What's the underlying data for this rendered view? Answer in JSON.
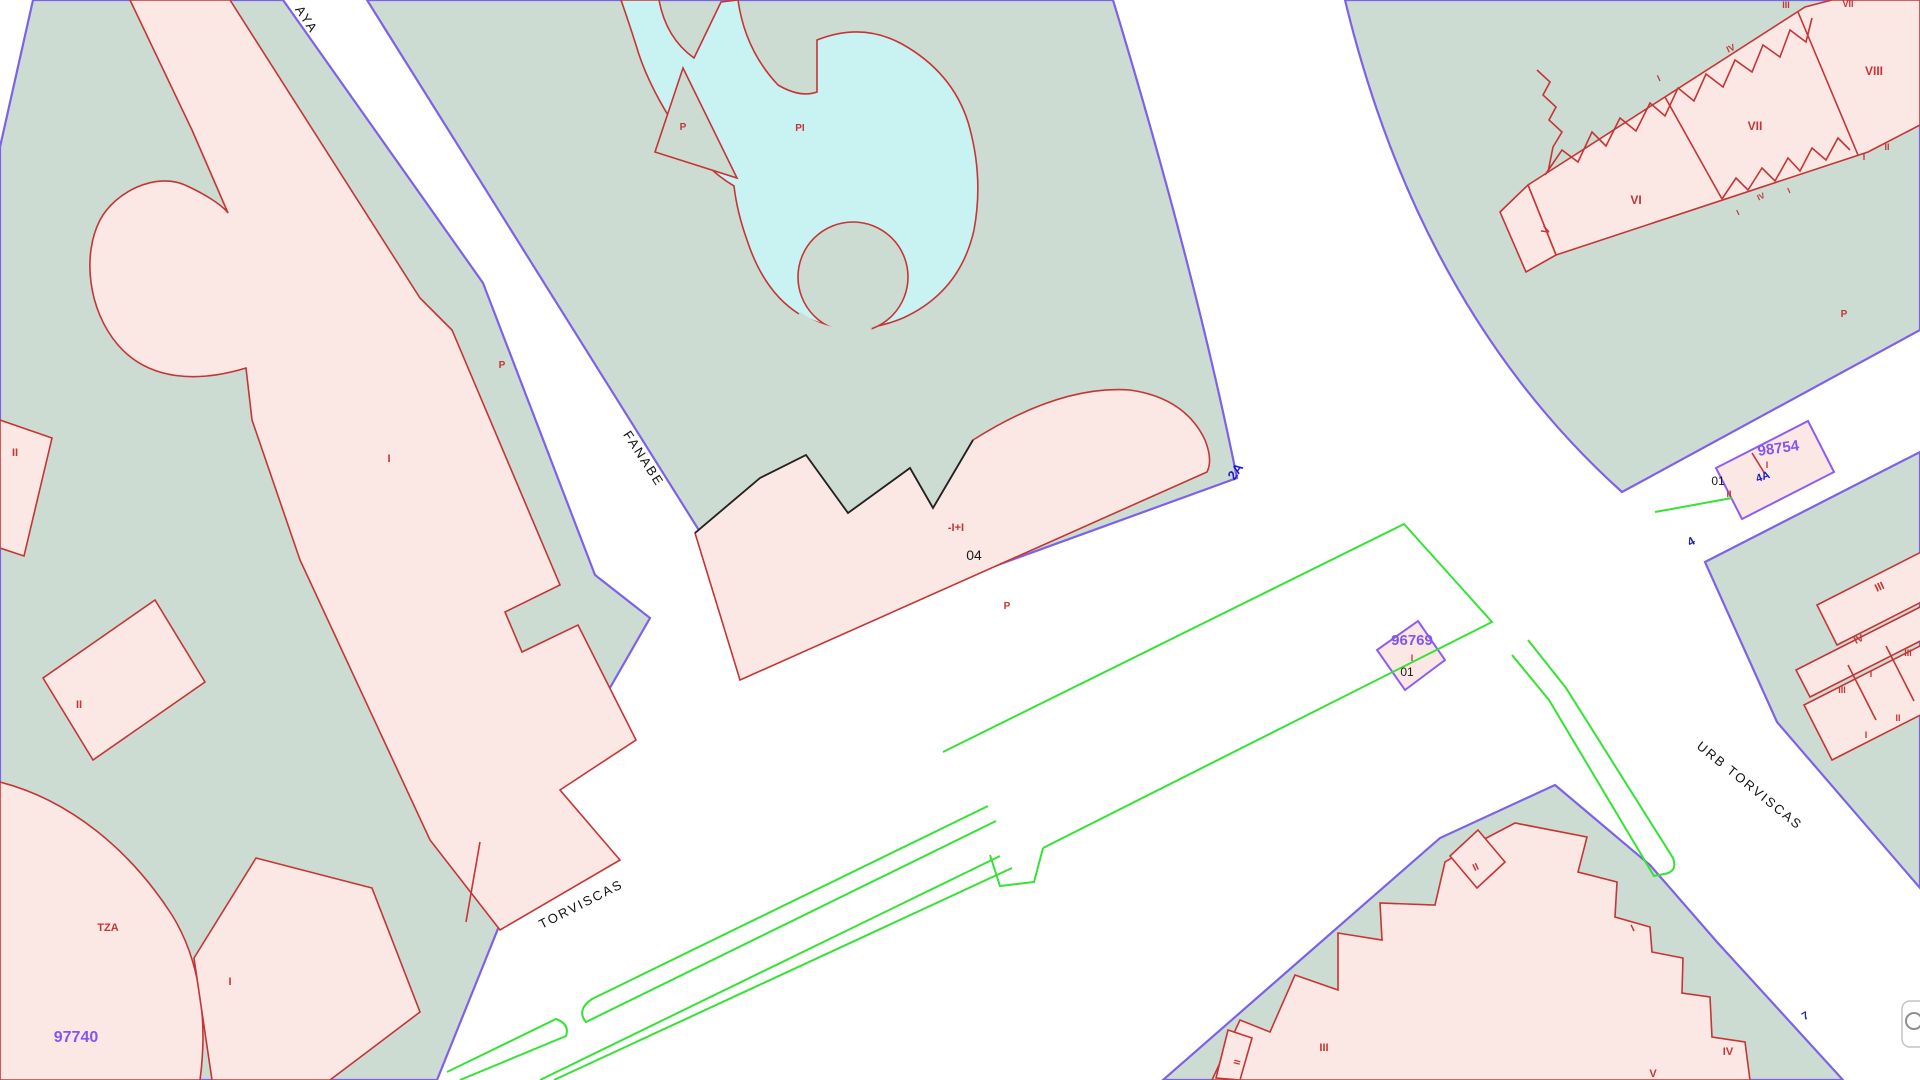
{
  "title": "Cadastral map viewer — Torviscas / Fanabe",
  "colors": {
    "street_white": "#ffffff",
    "block_green": "#ccdcd2",
    "parcel_pink": "#fbe7e4",
    "pool_cyan": "#c9f2f2",
    "outline_red": "#c53535",
    "boundary_purple": "#7d62e8",
    "curb_green": "#35e335",
    "parcel_number_purple": "#8257f0",
    "street_number_blue": "#1c1ccd",
    "text_black": "#1a1a1a"
  },
  "streets": [
    {
      "name": "AYA"
    },
    {
      "name": "FANABE"
    },
    {
      "name": "TORVISCAS"
    },
    {
      "name": "URB TORVISCAS"
    }
  ],
  "parcel_numbers": [
    "97740",
    "96769",
    "98754"
  ],
  "portal_numbers": [
    "04",
    "01",
    "01"
  ],
  "street_numbers": [
    "2A",
    "4",
    "4A",
    "7"
  ],
  "map_control": {
    "icon": "globe-icon"
  },
  "labels": [
    {
      "id": "street-aya",
      "t": "AYA",
      "x": 303,
      "y": 22,
      "c": "street",
      "s": 13,
      "r": 57
    },
    {
      "id": "street-fanabe",
      "t": "FANABE",
      "x": 640,
      "y": 461,
      "c": "street",
      "s": 13,
      "r": 57
    },
    {
      "id": "street-torviscas",
      "t": "TORVISCAS",
      "x": 583,
      "y": 908,
      "c": "street",
      "s": 13,
      "r": -27
    },
    {
      "id": "street-urb-torviscas",
      "t": "URB TORVISCAS",
      "x": 1747,
      "y": 789,
      "c": "street",
      "s": 13,
      "r": 39
    },
    {
      "id": "parcel-97740",
      "t": "97740",
      "x": 76,
      "y": 1042,
      "c": "ptext",
      "s": 16,
      "r": 0
    },
    {
      "id": "parcel-96769",
      "t": "96769",
      "x": 1412,
      "y": 645,
      "c": "ptext",
      "s": 15,
      "r": 0
    },
    {
      "id": "parcel-98754",
      "t": "98754",
      "x": 1779,
      "y": 453,
      "c": "ptext",
      "s": 15,
      "r": -8
    },
    {
      "id": "num-2a",
      "t": "2A",
      "x": 1239,
      "y": 474,
      "c": "blue",
      "s": 13,
      "r": -55
    },
    {
      "id": "num-4a",
      "t": "4A",
      "x": 1764,
      "y": 480,
      "c": "blue",
      "s": 11,
      "r": -20
    },
    {
      "id": "num-4",
      "t": "4",
      "x": 1693,
      "y": 545,
      "c": "blue",
      "s": 12,
      "r": -30
    },
    {
      "id": "num-7",
      "t": "7",
      "x": 1807,
      "y": 1019,
      "c": "blue",
      "s": 11,
      "r": -30
    },
    {
      "id": "portal-04",
      "t": "04",
      "x": 974,
      "y": 560,
      "c": "black",
      "s": 14,
      "r": 0
    },
    {
      "id": "portal-01-96769",
      "t": "01",
      "x": 1407,
      "y": 676,
      "c": "black",
      "s": 12,
      "r": 0
    },
    {
      "id": "portal-01-98754",
      "t": "01",
      "x": 1718,
      "y": 485,
      "c": "black",
      "s": 12,
      "r": 0
    },
    {
      "id": "bld-floors",
      "t": "-I+I",
      "x": 956,
      "y": 531,
      "c": "red",
      "s": 11,
      "r": 0
    },
    {
      "id": "bld-p-1",
      "t": "P",
      "x": 1007,
      "y": 609,
      "c": "red",
      "s": 10,
      "r": 0
    },
    {
      "id": "bld-p-2",
      "t": "P",
      "x": 502,
      "y": 368,
      "c": "red",
      "s": 10,
      "r": 0
    },
    {
      "id": "pool-p",
      "t": "P",
      "x": 683,
      "y": 130,
      "c": "red",
      "s": 10,
      "r": 0
    },
    {
      "id": "pool-pi",
      "t": "PI",
      "x": 800,
      "y": 131,
      "c": "red",
      "s": 10,
      "r": 0
    },
    {
      "id": "bld-p-3",
      "t": "P",
      "x": 1844,
      "y": 317,
      "c": "red",
      "s": 10,
      "r": 0
    },
    {
      "id": "bld-i-left",
      "t": "I",
      "x": 389,
      "y": 462,
      "c": "red",
      "s": 11,
      "r": 0
    },
    {
      "id": "bld-ii-far-left",
      "t": "II",
      "x": 15,
      "y": 456,
      "c": "red",
      "s": 11,
      "r": 0
    },
    {
      "id": "bld-ii-mid-left",
      "t": "II",
      "x": 79,
      "y": 708,
      "c": "red",
      "s": 11,
      "r": 0
    },
    {
      "id": "bld-tza",
      "t": "TZA",
      "x": 108,
      "y": 931,
      "c": "red",
      "s": 11,
      "r": 0
    },
    {
      "id": "bld-i-bl",
      "t": "I",
      "x": 230,
      "y": 985,
      "c": "red",
      "s": 11,
      "r": 0
    },
    {
      "id": "isl-ii",
      "t": "II",
      "x": 1729,
      "y": 497,
      "c": "red",
      "s": 9,
      "r": 0
    },
    {
      "id": "isl-i",
      "t": "I",
      "x": 1767,
      "y": 468,
      "c": "red",
      "s": 9,
      "r": 0
    },
    {
      "id": "isl2-i",
      "t": "I",
      "x": 1412,
      "y": 661,
      "c": "red",
      "s": 9,
      "r": 0
    },
    {
      "id": "bld-vi",
      "t": "VI",
      "x": 1636,
      "y": 204,
      "c": "red",
      "s": 12,
      "r": 0
    },
    {
      "id": "bld-vii",
      "t": "VII",
      "x": 1755,
      "y": 130,
      "c": "red",
      "s": 12,
      "r": 0
    },
    {
      "id": "bld-viii",
      "t": "VIII",
      "x": 1874,
      "y": 75,
      "c": "red",
      "s": 12,
      "r": 0
    },
    {
      "id": "bld-v-tail",
      "t": "V",
      "x": 1549,
      "y": 232,
      "c": "red",
      "s": 11,
      "r": -62
    },
    {
      "id": "bld-iv-top",
      "t": "IV",
      "x": 1732,
      "y": 51,
      "c": "red",
      "s": 9,
      "r": -25
    },
    {
      "id": "bld-i-top",
      "t": "I",
      "x": 1660,
      "y": 81,
      "c": "red",
      "s": 9,
      "r": -25
    },
    {
      "id": "bld-iii-edge",
      "t": "III",
      "x": 1786,
      "y": 8,
      "c": "red",
      "s": 9,
      "r": 0
    },
    {
      "id": "bld-vii-edge",
      "t": "VII",
      "x": 1848,
      "y": 7,
      "c": "red",
      "s": 9,
      "r": 0
    },
    {
      "id": "bld-ii-r",
      "t": "II",
      "x": 1887,
      "y": 150,
      "c": "red",
      "s": 9,
      "r": 0
    },
    {
      "id": "bld-i-r",
      "t": "I",
      "x": 1864,
      "y": 160,
      "c": "red",
      "s": 9,
      "r": 0
    },
    {
      "id": "teeth-i-1",
      "t": "I",
      "x": 1739,
      "y": 215,
      "c": "red",
      "s": 8,
      "r": -25
    },
    {
      "id": "teeth-iv",
      "t": "IV",
      "x": 1762,
      "y": 199,
      "c": "red",
      "s": 8,
      "r": -25
    },
    {
      "id": "teeth-i-2",
      "t": "I",
      "x": 1790,
      "y": 193,
      "c": "red",
      "s": 8,
      "r": -25
    },
    {
      "id": "wdg-iii-1",
      "t": "III",
      "x": 1881,
      "y": 590,
      "c": "red",
      "s": 11,
      "r": -25
    },
    {
      "id": "wdg-iv",
      "t": "IV",
      "x": 1860,
      "y": 642,
      "c": "red",
      "s": 10,
      "r": -25
    },
    {
      "id": "wdg-iii-2",
      "t": "III",
      "x": 1842,
      "y": 693,
      "c": "red",
      "s": 9,
      "r": 0
    },
    {
      "id": "wdg-i-1",
      "t": "I",
      "x": 1871,
      "y": 677,
      "c": "red",
      "s": 9,
      "r": 0
    },
    {
      "id": "wdg-iii-3",
      "t": "III",
      "x": 1908,
      "y": 656,
      "c": "red",
      "s": 9,
      "r": 0
    },
    {
      "id": "wdg-ii",
      "t": "II",
      "x": 1898,
      "y": 721,
      "c": "red",
      "s": 9,
      "r": 0
    },
    {
      "id": "wdg-i-2",
      "t": "I",
      "x": 1866,
      "y": 738,
      "c": "red",
      "s": 9,
      "r": 0
    },
    {
      "id": "br-ii-1",
      "t": "II",
      "x": 1477,
      "y": 870,
      "c": "red",
      "s": 10,
      "r": -25
    },
    {
      "id": "br-i-1",
      "t": "I",
      "x": 1634,
      "y": 931,
      "c": "red",
      "s": 10,
      "r": -25
    },
    {
      "id": "br-iii",
      "t": "III",
      "x": 1324,
      "y": 1051,
      "c": "red",
      "s": 11,
      "r": 0
    },
    {
      "id": "br-ii-2",
      "t": "II",
      "x": 1240,
      "y": 1063,
      "c": "red",
      "s": 9,
      "r": -75
    },
    {
      "id": "br-v",
      "t": "V",
      "x": 1653,
      "y": 1077,
      "c": "red",
      "s": 11,
      "r": 0
    },
    {
      "id": "br-iv",
      "t": "IV",
      "x": 1728,
      "y": 1055,
      "c": "red",
      "s": 11,
      "r": 0
    }
  ]
}
